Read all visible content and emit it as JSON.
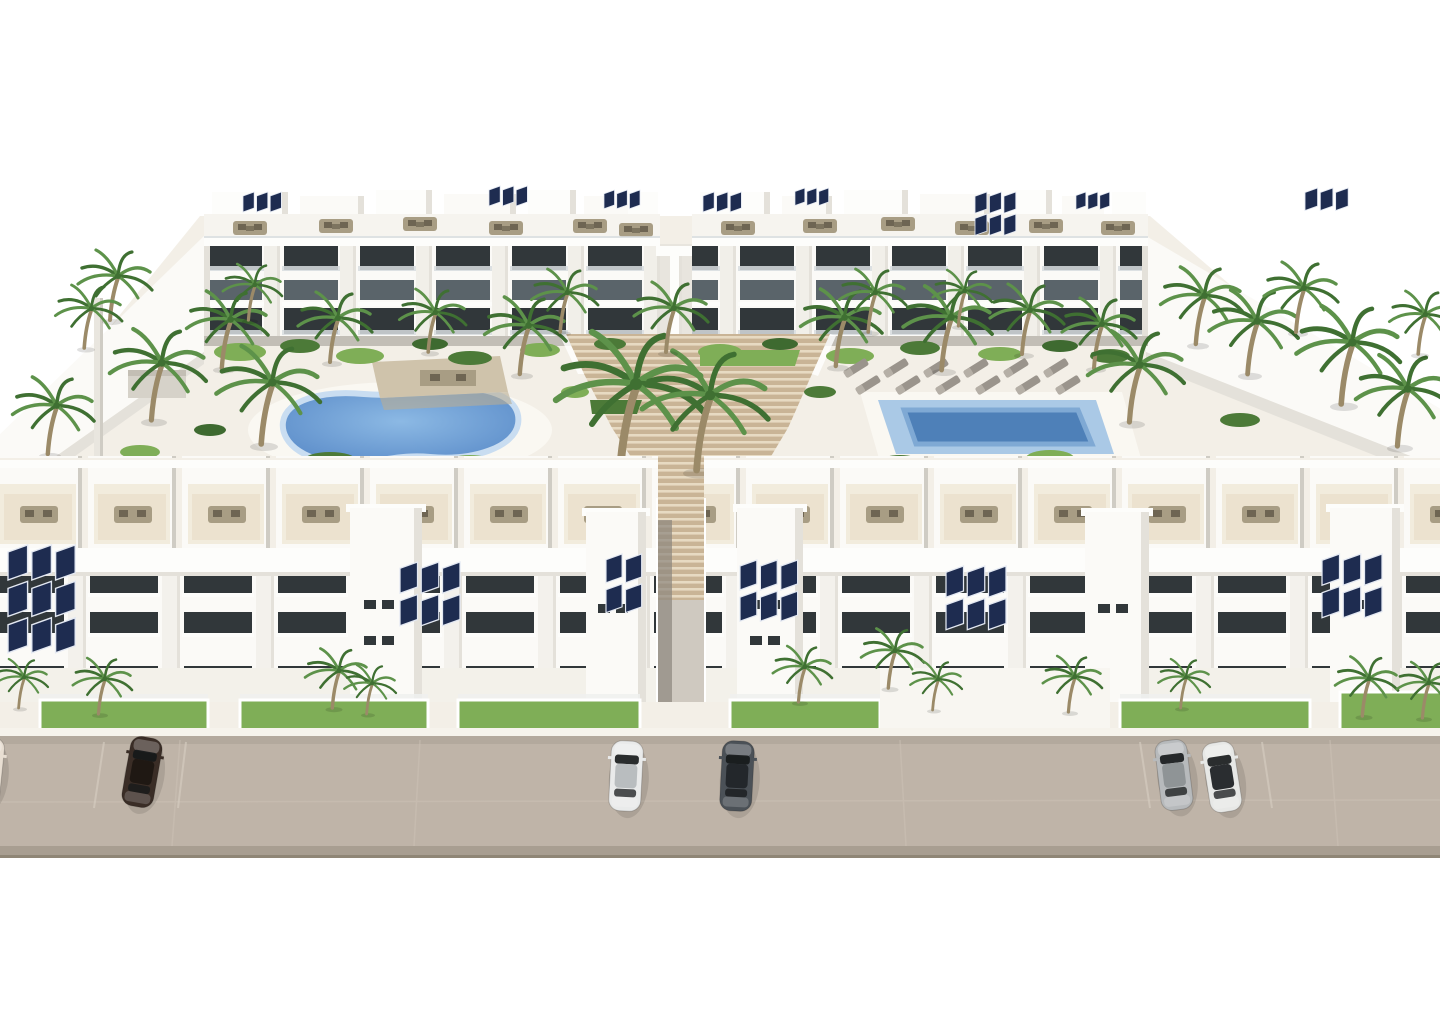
{
  "meta": {
    "title": "Aerial 3D architectural rendering of a white Mediterranean apartment complex",
    "canvas": {
      "width": 1440,
      "height": 1024
    },
    "visible_text": []
  },
  "palette": {
    "bg": "#ffffff",
    "terrain": "#f3efe7",
    "deck": "#faf8f2",
    "white": "#fdfdfb",
    "whiteWarm": "#fbfaf7",
    "shade": "#e4e1da",
    "shadeDark": "#cfccc4",
    "wallGray": "#b7b2a9",
    "window": "#31373a",
    "windowSoft": "#5a646a",
    "railing": "#d8dde0",
    "road": "#bfb4a8",
    "roadDark": "#a89e91",
    "stairTan": "#c9b496",
    "stairLight": "#e7dac2",
    "terraceTan": "#ead fc9",
    "terraceLight": "#f2ecdd",
    "furnTan": "#a89d84",
    "furnDark": "#6e6553",
    "grass": "#7fae57",
    "grassDark": "#4c7a38",
    "bushDark": "#3e6a30",
    "palmGreen": "#5d924a",
    "palmDark": "#3f7032",
    "trunk": "#9b8a68",
    "poolDeep": "#5b8cc9",
    "poolMid": "#8cb9e4",
    "poolLight": "#aac9e6",
    "poolInner": "#4e80b8",
    "poolRim": "#c9ddf1",
    "solar": "#1e2c50",
    "solarFrame": "#e3e8f2"
  },
  "scene": {
    "buildings": [
      {
        "name": "back-left-apartment-block",
        "floors": 3,
        "features": [
          "roof terraces",
          "solar panels",
          "balconies"
        ]
      },
      {
        "name": "back-right-apartment-block",
        "floors": 3,
        "features": [
          "roof terraces",
          "solar panels",
          "balconies"
        ]
      },
      {
        "name": "front-left-apartment-block",
        "floors": 3,
        "features": [
          "roof terraces",
          "solar panels",
          "private gardens"
        ]
      },
      {
        "name": "front-right-apartment-block",
        "floors": 3,
        "features": [
          "roof terraces",
          "solar panels",
          "private gardens"
        ]
      }
    ],
    "pools": [
      {
        "name": "kidney-pool",
        "shape": "kidney",
        "position": "left courtyard"
      },
      {
        "name": "lap-pool",
        "shape": "rectangular",
        "position": "right courtyard"
      }
    ],
    "stairs": {
      "name": "central-terraced-stairs",
      "material": "timber decking"
    },
    "road": {
      "name": "street",
      "car_count": 6
    },
    "palms": [
      {
        "x": 112,
        "y": 320,
        "s": 1.0,
        "l": "b"
      },
      {
        "x": 86,
        "y": 348,
        "s": 0.9,
        "l": "b"
      },
      {
        "x": 154,
        "y": 420,
        "s": 1.3,
        "l": "b"
      },
      {
        "x": 224,
        "y": 368,
        "s": 1.1,
        "l": "b"
      },
      {
        "x": 264,
        "y": 444,
        "s": 1.4,
        "l": "b"
      },
      {
        "x": 332,
        "y": 362,
        "s": 1.0,
        "l": "b"
      },
      {
        "x": 430,
        "y": 352,
        "s": 0.9,
        "l": "b"
      },
      {
        "x": 522,
        "y": 374,
        "s": 1.1,
        "l": "b"
      },
      {
        "x": 562,
        "y": 332,
        "s": 0.9,
        "l": "b"
      },
      {
        "x": 624,
        "y": 472,
        "s": 2.0,
        "l": "b"
      },
      {
        "x": 700,
        "y": 470,
        "s": 1.7,
        "l": "b"
      },
      {
        "x": 668,
        "y": 352,
        "s": 1.0,
        "l": "b"
      },
      {
        "x": 838,
        "y": 366,
        "s": 1.1,
        "l": "b"
      },
      {
        "x": 870,
        "y": 332,
        "s": 0.9,
        "l": "b"
      },
      {
        "x": 944,
        "y": 370,
        "s": 1.2,
        "l": "b"
      },
      {
        "x": 1024,
        "y": 354,
        "s": 1.0,
        "l": "b"
      },
      {
        "x": 1096,
        "y": 368,
        "s": 1.0,
        "l": "b"
      },
      {
        "x": 1132,
        "y": 422,
        "s": 1.3,
        "l": "b"
      },
      {
        "x": 1198,
        "y": 344,
        "s": 1.1,
        "l": "b"
      },
      {
        "x": 1250,
        "y": 374,
        "s": 1.2,
        "l": "b"
      },
      {
        "x": 1298,
        "y": 332,
        "s": 1.0,
        "l": "b"
      },
      {
        "x": 1344,
        "y": 404,
        "s": 1.4,
        "l": "b"
      },
      {
        "x": 1400,
        "y": 446,
        "s": 1.3,
        "l": "b"
      },
      {
        "x": 50,
        "y": 454,
        "s": 1.1,
        "l": "b"
      },
      {
        "x": 1420,
        "y": 354,
        "s": 0.9,
        "l": "b"
      },
      {
        "x": 250,
        "y": 320,
        "s": 0.8,
        "l": "b"
      },
      {
        "x": 960,
        "y": 326,
        "s": 0.8,
        "l": "b"
      },
      {
        "x": 100,
        "y": 714,
        "s": 0.8,
        "l": "f"
      },
      {
        "x": 20,
        "y": 708,
        "s": 0.7,
        "l": "f"
      },
      {
        "x": 334,
        "y": 708,
        "s": 0.85,
        "l": "f"
      },
      {
        "x": 368,
        "y": 714,
        "s": 0.7,
        "l": "f"
      },
      {
        "x": 800,
        "y": 702,
        "s": 0.8,
        "l": "f"
      },
      {
        "x": 890,
        "y": 688,
        "s": 0.85,
        "l": "f"
      },
      {
        "x": 934,
        "y": 710,
        "s": 0.7,
        "l": "f"
      },
      {
        "x": 1070,
        "y": 712,
        "s": 0.8,
        "l": "f"
      },
      {
        "x": 1182,
        "y": 708,
        "s": 0.7,
        "l": "f"
      },
      {
        "x": 1364,
        "y": 716,
        "s": 0.85,
        "l": "f"
      },
      {
        "x": 1424,
        "y": 718,
        "s": 0.8,
        "l": "f"
      }
    ],
    "bushes": [
      {
        "x": 240,
        "y": 352,
        "rx": 26,
        "ry": 9,
        "t": 0
      },
      {
        "x": 300,
        "y": 346,
        "rx": 20,
        "ry": 7,
        "t": 1
      },
      {
        "x": 360,
        "y": 356,
        "rx": 24,
        "ry": 8,
        "t": 0
      },
      {
        "x": 430,
        "y": 344,
        "rx": 18,
        "ry": 6,
        "t": 2
      },
      {
        "x": 470,
        "y": 358,
        "rx": 22,
        "ry": 7,
        "t": 1
      },
      {
        "x": 540,
        "y": 350,
        "rx": 20,
        "ry": 7,
        "t": 0
      },
      {
        "x": 610,
        "y": 344,
        "rx": 16,
        "ry": 6,
        "t": 1
      },
      {
        "x": 720,
        "y": 352,
        "rx": 22,
        "ry": 8,
        "t": 0
      },
      {
        "x": 780,
        "y": 344,
        "rx": 18,
        "ry": 6,
        "t": 2
      },
      {
        "x": 850,
        "y": 356,
        "rx": 24,
        "ry": 8,
        "t": 0
      },
      {
        "x": 920,
        "y": 348,
        "rx": 20,
        "ry": 7,
        "t": 1
      },
      {
        "x": 1000,
        "y": 354,
        "rx": 22,
        "ry": 7,
        "t": 0
      },
      {
        "x": 1060,
        "y": 346,
        "rx": 18,
        "ry": 6,
        "t": 2
      },
      {
        "x": 1110,
        "y": 356,
        "rx": 20,
        "ry": 7,
        "t": 1
      },
      {
        "x": 330,
        "y": 460,
        "rx": 26,
        "ry": 8,
        "t": 1
      },
      {
        "x": 470,
        "y": 462,
        "rx": 22,
        "ry": 7,
        "t": 0
      },
      {
        "x": 900,
        "y": 462,
        "rx": 20,
        "ry": 7,
        "t": 1
      },
      {
        "x": 1050,
        "y": 458,
        "rx": 24,
        "ry": 8,
        "t": 0
      },
      {
        "x": 210,
        "y": 430,
        "rx": 16,
        "ry": 6,
        "t": 2
      },
      {
        "x": 1240,
        "y": 420,
        "rx": 20,
        "ry": 7,
        "t": 1
      },
      {
        "x": 575,
        "y": 392,
        "rx": 14,
        "ry": 6,
        "t": 0
      },
      {
        "x": 820,
        "y": 392,
        "rx": 16,
        "ry": 6,
        "t": 1
      },
      {
        "x": 140,
        "y": 452,
        "rx": 20,
        "ry": 7,
        "t": 0
      },
      {
        "x": 1385,
        "y": 468,
        "rx": 22,
        "ry": 8,
        "t": 1
      }
    ],
    "loungers": [
      {
        "x": 856,
        "y": 368
      },
      {
        "x": 896,
        "y": 368
      },
      {
        "x": 936,
        "y": 368
      },
      {
        "x": 976,
        "y": 368
      },
      {
        "x": 1016,
        "y": 368
      },
      {
        "x": 1056,
        "y": 368
      },
      {
        "x": 868,
        "y": 385
      },
      {
        "x": 908,
        "y": 385
      },
      {
        "x": 948,
        "y": 385
      },
      {
        "x": 988,
        "y": 385
      },
      {
        "x": 1028,
        "y": 385
      },
      {
        "x": 1068,
        "y": 385
      }
    ],
    "solar_arrays": [
      {
        "x": 243,
        "y": 192,
        "s": 0.8,
        "cols": 3,
        "rows": 1
      },
      {
        "x": 489,
        "y": 186,
        "s": 0.8,
        "cols": 3,
        "rows": 1
      },
      {
        "x": 604,
        "y": 190,
        "s": 0.75,
        "cols": 3,
        "rows": 1
      },
      {
        "x": 703,
        "y": 192,
        "s": 0.8,
        "cols": 3,
        "rows": 1
      },
      {
        "x": 795,
        "y": 188,
        "s": 0.7,
        "cols": 3,
        "rows": 1
      },
      {
        "x": 975,
        "y": 192,
        "s": 0.85,
        "cols": 3,
        "rows": 2
      },
      {
        "x": 1076,
        "y": 192,
        "s": 0.7,
        "cols": 3,
        "rows": 1
      },
      {
        "x": 1305,
        "y": 188,
        "s": 0.9,
        "cols": 3,
        "rows": 1
      },
      {
        "x": 8,
        "y": 545,
        "s": 1.4,
        "cols": 3,
        "rows": 3
      },
      {
        "x": 400,
        "y": 562,
        "s": 1.25,
        "cols": 3,
        "rows": 2
      },
      {
        "x": 606,
        "y": 554,
        "s": 1.15,
        "cols": 2,
        "rows": 2
      },
      {
        "x": 740,
        "y": 560,
        "s": 1.2,
        "cols": 3,
        "rows": 2
      },
      {
        "x": 946,
        "y": 566,
        "s": 1.25,
        "cols": 3,
        "rows": 2
      },
      {
        "x": 1322,
        "y": 554,
        "s": 1.25,
        "cols": 3,
        "rows": 2
      }
    ],
    "cars": [
      {
        "name": "car-cream-partial",
        "x": -14,
        "y": 772,
        "rot": 6,
        "body": "#e8ded2",
        "roof": "#b9ac9c"
      },
      {
        "name": "car-dark-brown",
        "x": 142,
        "y": 772,
        "rot": 10,
        "body": "#3a2d26",
        "roof": "#1f1813"
      },
      {
        "name": "car-white",
        "x": 626,
        "y": 776,
        "rot": 3,
        "body": "#e9eaea",
        "roof": "#b9bdbf"
      },
      {
        "name": "car-dark-gray",
        "x": 737,
        "y": 776,
        "rot": 3,
        "body": "#4b5157",
        "roof": "#23272b"
      },
      {
        "name": "car-silver-suv",
        "x": 1174,
        "y": 775,
        "rot": -7,
        "body": "#b7babc",
        "roof": "#8f9496"
      },
      {
        "name": "car-white-black-roof",
        "x": 1222,
        "y": 777,
        "rot": -9,
        "body": "#e7e8e6",
        "roof": "#2a2d30"
      }
    ]
  }
}
